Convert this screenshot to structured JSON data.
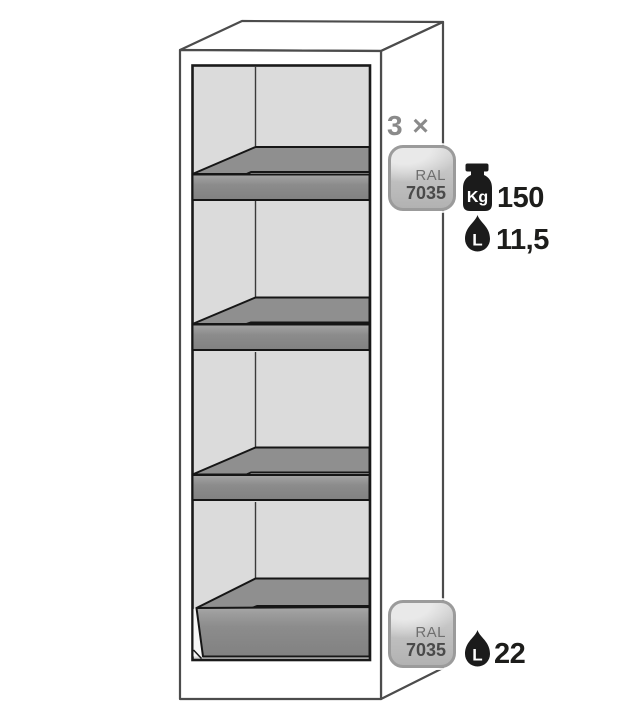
{
  "figure": {
    "kind": "safety-cabinet-interior-diagram",
    "shelves_shown": 3,
    "sump_shown": 1
  },
  "shelf_annotations": {
    "count_label": "3 ×",
    "ral_badge": {
      "series": "RAL",
      "code": "7035"
    },
    "load": {
      "unit": "Kg",
      "value": "150"
    },
    "volume": {
      "unit": "L",
      "value": "11,5"
    }
  },
  "sump_annotations": {
    "ral_badge": {
      "series": "RAL",
      "code": "7035"
    },
    "volume": {
      "unit": "L",
      "value": "22"
    }
  },
  "icons": {
    "weight": "weight-icon",
    "drop": "drop-icon",
    "ral_swatch": "ral-7035-swatch"
  },
  "colors": {
    "shelf_gray": "#8f8f8f",
    "interior_wall_gray": "#dbdbdb",
    "cabinet_outline": "#4c4c4c",
    "interior_outline": "#1a1a1a",
    "badge_border": "#9b9b9b",
    "annotation_gray": "#8a8a8a",
    "annotation_black": "#1d1d1b",
    "ral_code_color": "#4a4a4a"
  }
}
